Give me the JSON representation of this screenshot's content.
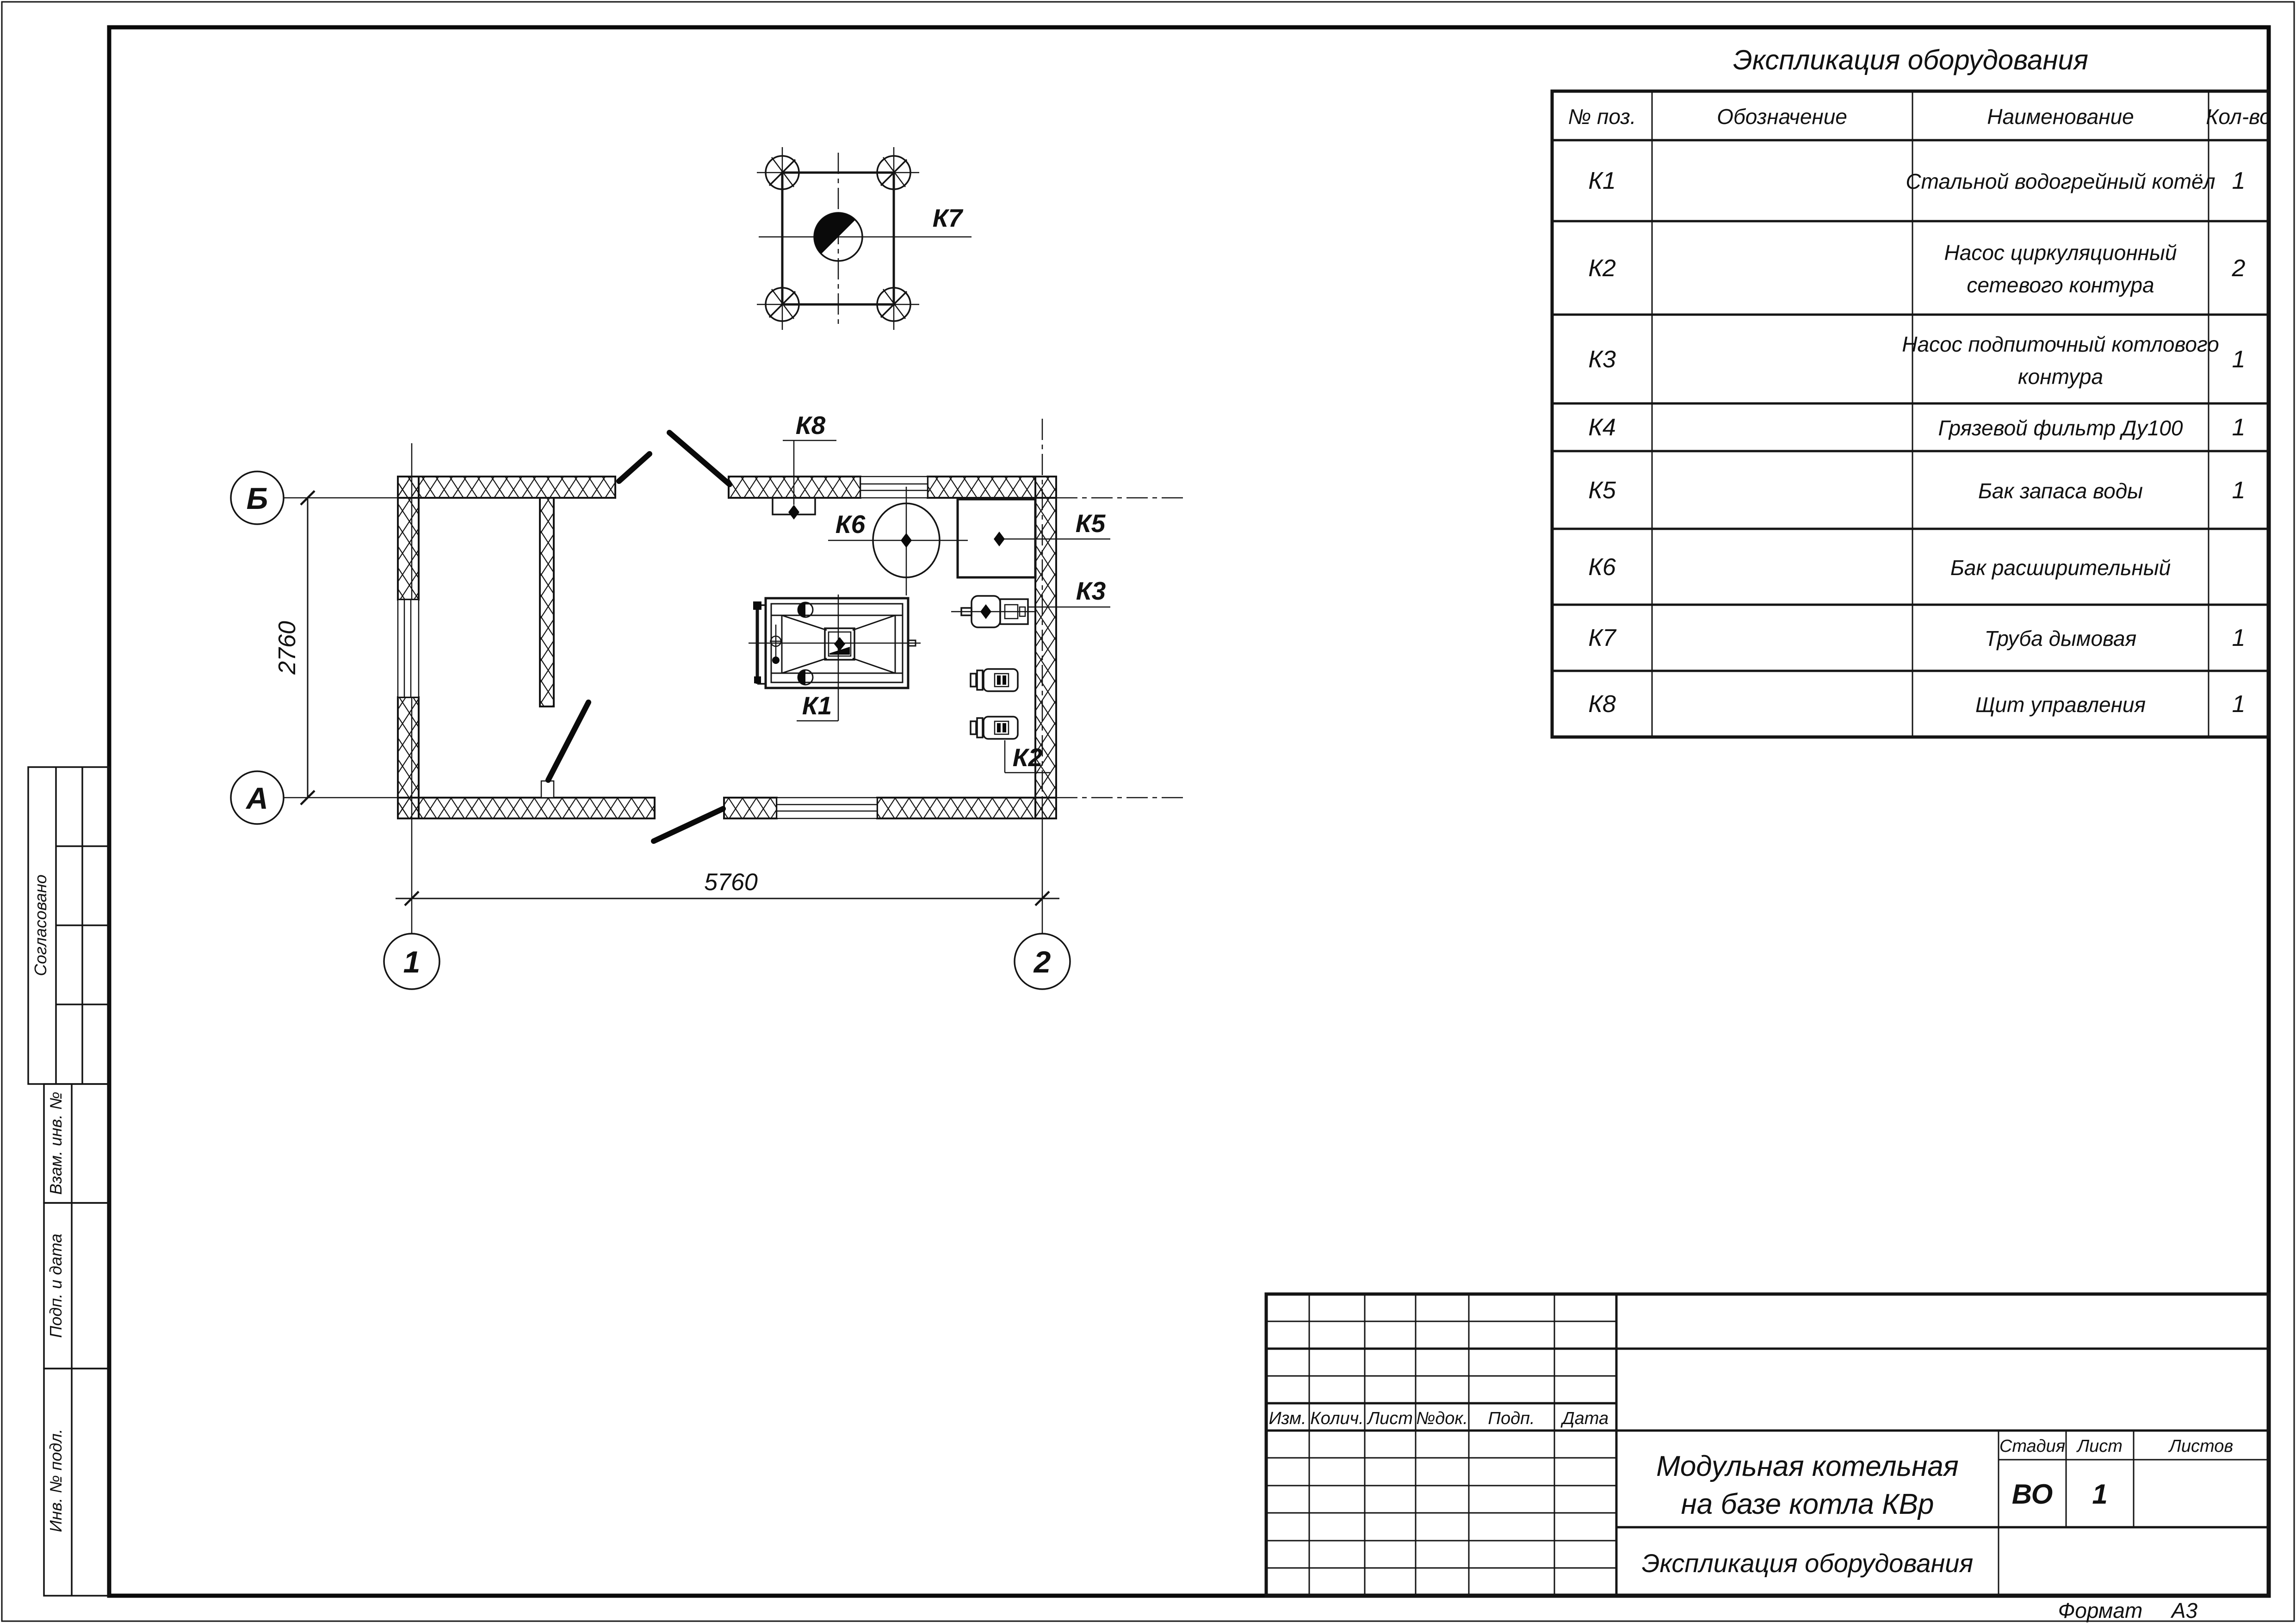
{
  "equipment_table": {
    "title": "Экспликация оборудования",
    "headers": [
      "№ поз.",
      "Обозначение",
      "Наименование",
      "Кол-во"
    ],
    "rows": [
      {
        "pos": "К1",
        "designation": "",
        "lines": [
          "Стальной водогрейный котёл"
        ],
        "qty": "1"
      },
      {
        "pos": "К2",
        "designation": "",
        "lines": [
          "Насос циркуляционный",
          "сетевого контура"
        ],
        "qty": "2"
      },
      {
        "pos": "К3",
        "designation": "",
        "lines": [
          "Насос подпиточный котлового",
          "контура"
        ],
        "qty": "1"
      },
      {
        "pos": "К4",
        "designation": "",
        "lines": [
          "Грязевой фильтр Ду100"
        ],
        "qty": "1"
      },
      {
        "pos": "К5",
        "designation": "",
        "lines": [
          "Бак запаса воды"
        ],
        "qty": "1"
      },
      {
        "pos": "К6",
        "designation": "",
        "lines": [
          "Бак расширительный"
        ],
        "qty": ""
      },
      {
        "pos": "К7",
        "designation": "",
        "lines": [
          "Труба дымовая"
        ],
        "qty": "1"
      },
      {
        "pos": "К8",
        "designation": "",
        "lines": [
          "Щит управления"
        ],
        "qty": "1"
      }
    ]
  },
  "plan": {
    "axes": {
      "row_top": "Б",
      "row_bottom": "А",
      "col_left": "1",
      "col_right": "2"
    },
    "dimensions": {
      "width": "5760",
      "height": "2760"
    },
    "callouts": {
      "k1": "К1",
      "k2": "К2",
      "k3": "К3",
      "k5": "К5",
      "k6": "К6",
      "k7": "К7",
      "k8": "К8"
    }
  },
  "title_block": {
    "revision_headers": [
      "Изм.",
      "Колич.",
      "Лист",
      "№док.",
      "Подп.",
      "Дата"
    ],
    "project_lines": [
      "Модульная котельная",
      "на базе котла КВр"
    ],
    "doc_title": "Экспликация оборудования",
    "stage_header": "Стадия",
    "sheet_header": "Лист",
    "sheets_header": "Листов",
    "stage": "ВО",
    "sheet": "1",
    "sheets": "",
    "format_word": "Формат",
    "format_value": "А3"
  },
  "side_stamp": {
    "approved": "Согласовано",
    "blocks": [
      "Взам. инв. №",
      "Подп. и дата",
      "Инв. № подл."
    ]
  }
}
